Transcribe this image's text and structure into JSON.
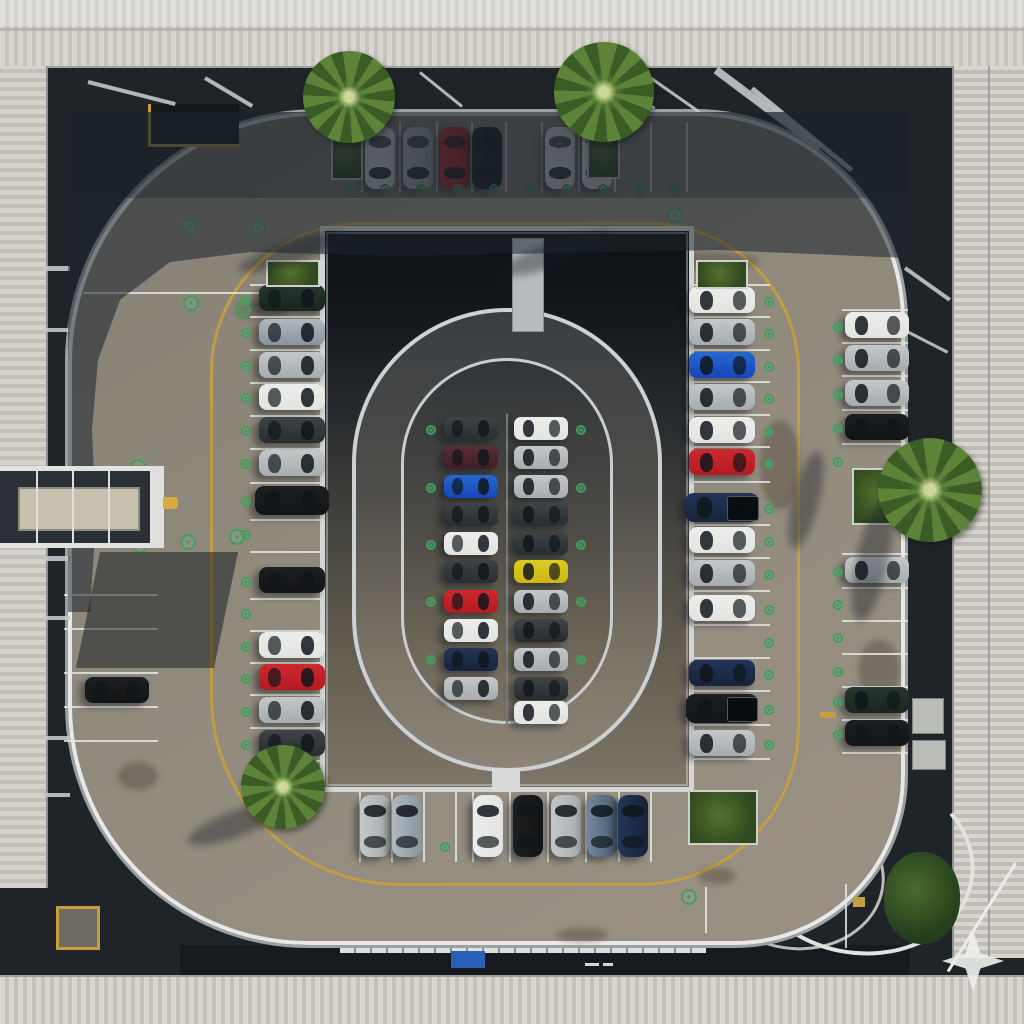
{
  "canvas": {
    "w": 1024,
    "h": 1024
  },
  "scene_palette": {
    "deck": "#8f897c",
    "gap": "#1f2428",
    "roof_light": "#d8d6cf",
    "roof_dark": "#c3c1ba",
    "curb_white": "#e8e9e6",
    "lane_yellow": "#c59e3d",
    "parking_line": "#e4e5e1",
    "ev_marker_green": "#3da05c",
    "shadow": "rgba(28,36,45,0.55)",
    "car_colors": {
      "white": "#e7e8e6",
      "silver": "#b4b8ba",
      "silverblue": "#99a5ad",
      "red": "#bf2127",
      "maroon": "#4a262b",
      "black": "#17191b",
      "darkgray": "#32373a",
      "darkgreen": "#1f2d26",
      "blue": "#1e55c4",
      "navy": "#1c2b48",
      "yellow": "#d4c019",
      "bluegray": "#5c7085"
    }
  },
  "car_groups": [
    {
      "name": "top-row",
      "o": "down",
      "cy": 158,
      "l": 62,
      "w": 30,
      "items": [
        {
          "p": 380,
          "c": "white"
        },
        {
          "p": 418,
          "c": "silver"
        },
        {
          "p": 455,
          "c": "red"
        },
        {
          "p": 487,
          "c": "black"
        },
        {
          "p": 560,
          "c": "white"
        },
        {
          "p": 597,
          "c": "white"
        }
      ]
    },
    {
      "name": "left-column",
      "o": "right",
      "cx": 292,
      "l": 66,
      "w": 26,
      "items": [
        {
          "p": 298,
          "c": "darkgreen"
        },
        {
          "p": 332,
          "c": "silverblue"
        },
        {
          "p": 365,
          "c": "silver"
        },
        {
          "p": 397,
          "c": "white"
        },
        {
          "p": 430,
          "c": "darkgray"
        },
        {
          "p": 463,
          "c": "silver"
        },
        {
          "p": 500,
          "c": "black",
          "l": 74,
          "w": 29
        },
        {
          "p": 580,
          "c": "black"
        },
        {
          "p": 645,
          "c": "white"
        },
        {
          "p": 677,
          "c": "red"
        },
        {
          "p": 710,
          "c": "silver"
        },
        {
          "p": 743,
          "c": "darkgray"
        }
      ]
    },
    {
      "name": "right-column",
      "o": "left",
      "cx": 722,
      "l": 66,
      "w": 26,
      "items": [
        {
          "p": 300,
          "c": "white"
        },
        {
          "p": 332,
          "c": "silver"
        },
        {
          "p": 365,
          "c": "blue"
        },
        {
          "p": 397,
          "c": "silver"
        },
        {
          "p": 430,
          "c": "white"
        },
        {
          "p": 462,
          "c": "red"
        },
        {
          "p": 507,
          "c": "navy",
          "l": 74,
          "w": 29,
          "truck": true
        },
        {
          "p": 540,
          "c": "white"
        },
        {
          "p": 573,
          "c": "silver"
        },
        {
          "p": 608,
          "c": "white"
        },
        {
          "p": 673,
          "c": "navy"
        },
        {
          "p": 708,
          "c": "black",
          "l": 72,
          "w": 29,
          "truck": true
        },
        {
          "p": 743,
          "c": "silver"
        }
      ]
    },
    {
      "name": "far-right-column",
      "o": "left",
      "cx": 877,
      "l": 64,
      "w": 26,
      "items": [
        {
          "p": 325,
          "c": "white"
        },
        {
          "p": 358,
          "c": "silver"
        },
        {
          "p": 393,
          "c": "silver"
        },
        {
          "p": 427,
          "c": "black"
        },
        {
          "p": 570,
          "c": "silver"
        },
        {
          "p": 700,
          "c": "darkgreen"
        },
        {
          "p": 733,
          "c": "black"
        }
      ]
    },
    {
      "name": "bottom-row",
      "o": "up",
      "cy": 826,
      "l": 62,
      "w": 30,
      "items": [
        {
          "p": 375,
          "c": "silver"
        },
        {
          "p": 407,
          "c": "silverblue"
        },
        {
          "p": 488,
          "c": "white"
        },
        {
          "p": 528,
          "c": "black"
        },
        {
          "p": 566,
          "c": "silver"
        },
        {
          "p": 602,
          "c": "bluegray"
        },
        {
          "p": 633,
          "c": "navy"
        }
      ]
    },
    {
      "name": "far-left",
      "o": "right",
      "cx": 117,
      "l": 64,
      "w": 26,
      "items": [
        {
          "p": 690,
          "c": "black"
        }
      ]
    },
    {
      "name": "center-left-column",
      "o": "right",
      "cx": 471,
      "l": 54,
      "w": 23,
      "items": [
        {
          "p": 428,
          "c": "darkgray"
        },
        {
          "p": 457,
          "c": "maroon"
        },
        {
          "p": 486,
          "c": "blue"
        },
        {
          "p": 514,
          "c": "darkgray"
        },
        {
          "p": 543,
          "c": "white"
        },
        {
          "p": 571,
          "c": "darkgray"
        },
        {
          "p": 601,
          "c": "red"
        },
        {
          "p": 630,
          "c": "white"
        },
        {
          "p": 659,
          "c": "navy"
        },
        {
          "p": 688,
          "c": "silver"
        }
      ]
    },
    {
      "name": "center-right-column",
      "o": "left",
      "cx": 541,
      "l": 54,
      "w": 23,
      "items": [
        {
          "p": 428,
          "c": "white"
        },
        {
          "p": 457,
          "c": "silver"
        },
        {
          "p": 486,
          "c": "silver"
        },
        {
          "p": 514,
          "c": "darkgray"
        },
        {
          "p": 543,
          "c": "darkgray"
        },
        {
          "p": 571,
          "c": "yellow"
        },
        {
          "p": 601,
          "c": "silver"
        },
        {
          "p": 630,
          "c": "darkgray"
        },
        {
          "p": 659,
          "c": "silver"
        },
        {
          "p": 688,
          "c": "darkgray"
        },
        {
          "p": 712,
          "c": "white"
        }
      ]
    }
  ],
  "line_groups": [
    {
      "dir": "v",
      "y1": 122,
      "y2": 192,
      "xs": [
        361,
        399,
        436,
        471,
        505,
        541,
        578,
        614,
        650,
        686
      ]
    },
    {
      "dir": "h",
      "x1": 250,
      "x2": 324,
      "ys": [
        284,
        316,
        349,
        382,
        415,
        448,
        482,
        519,
        551,
        598,
        630,
        662,
        694,
        727,
        760
      ]
    },
    {
      "dir": "h",
      "x1": 688,
      "x2": 770,
      "ys": [
        284,
        316,
        349,
        381,
        414,
        446,
        481,
        524,
        557,
        590,
        624,
        657,
        690,
        724,
        758
      ]
    },
    {
      "dir": "h",
      "x1": 842,
      "x2": 908,
      "ys": [
        309,
        342,
        375,
        409,
        443,
        553,
        587,
        620,
        653,
        686,
        719,
        752
      ]
    },
    {
      "dir": "v",
      "y1": 792,
      "y2": 862,
      "xs": [
        359,
        391,
        423,
        455,
        472,
        509,
        547,
        585,
        618,
        650
      ]
    },
    {
      "dir": "h",
      "x1": 436,
      "x2": 576,
      "ys": [
        414,
        443,
        471,
        500,
        528,
        557,
        586,
        614,
        643,
        671,
        700,
        726
      ]
    },
    {
      "dir": "h",
      "x1": 64,
      "x2": 158,
      "ys": [
        594,
        628,
        672,
        706,
        740
      ]
    },
    {
      "dir": "h",
      "x1": 84,
      "x2": 310,
      "ys": [
        292
      ]
    },
    {
      "dir": "v",
      "y1": 884,
      "y2": 948,
      "xs": [
        845
      ]
    },
    {
      "dir": "v",
      "y1": 887,
      "y2": 933,
      "xs": [
        705
      ]
    }
  ],
  "divider_lines": [
    {
      "x": 506,
      "y1": 414,
      "y2": 726
    }
  ],
  "markers": {
    "small": [
      [
        348,
        189
      ],
      [
        385,
        189
      ],
      [
        421,
        189
      ],
      [
        458,
        189
      ],
      [
        494,
        189
      ],
      [
        530,
        189
      ],
      [
        567,
        189
      ],
      [
        603,
        189
      ],
      [
        640,
        189
      ],
      [
        676,
        189
      ],
      [
        246,
        300
      ],
      [
        246,
        333
      ],
      [
        246,
        366
      ],
      [
        246,
        398
      ],
      [
        246,
        431
      ],
      [
        246,
        464
      ],
      [
        246,
        502
      ],
      [
        246,
        535
      ],
      [
        246,
        582
      ],
      [
        246,
        614
      ],
      [
        246,
        647
      ],
      [
        246,
        679
      ],
      [
        246,
        712
      ],
      [
        246,
        745
      ],
      [
        769,
        302
      ],
      [
        769,
        334
      ],
      [
        769,
        367
      ],
      [
        769,
        399
      ],
      [
        769,
        432
      ],
      [
        769,
        464
      ],
      [
        769,
        509
      ],
      [
        769,
        542
      ],
      [
        769,
        575
      ],
      [
        769,
        610
      ],
      [
        769,
        643
      ],
      [
        769,
        675
      ],
      [
        769,
        710
      ],
      [
        769,
        745
      ],
      [
        838,
        327
      ],
      [
        838,
        360
      ],
      [
        838,
        395
      ],
      [
        838,
        429
      ],
      [
        838,
        462
      ],
      [
        838,
        572
      ],
      [
        838,
        605
      ],
      [
        838,
        638
      ],
      [
        838,
        672
      ],
      [
        838,
        702
      ],
      [
        838,
        735
      ],
      [
        431,
        430
      ],
      [
        431,
        488
      ],
      [
        431,
        545
      ],
      [
        431,
        602
      ],
      [
        431,
        660
      ],
      [
        581,
        430
      ],
      [
        581,
        488
      ],
      [
        581,
        545
      ],
      [
        581,
        602
      ],
      [
        581,
        660
      ],
      [
        445,
        847
      ]
    ],
    "road": [
      [
        190,
        226
      ],
      [
        258,
        228
      ],
      [
        191,
        303
      ],
      [
        243,
        310
      ],
      [
        675,
        215
      ],
      [
        138,
        467
      ],
      [
        140,
        545
      ],
      [
        188,
        542
      ],
      [
        237,
        537
      ],
      [
        689,
        897
      ]
    ]
  },
  "palms": [
    {
      "x": 349,
      "y": 97,
      "r": 46
    },
    {
      "x": 604,
      "y": 92,
      "r": 50
    },
    {
      "x": 930,
      "y": 490,
      "r": 52
    },
    {
      "x": 283,
      "y": 787,
      "r": 42
    }
  ],
  "planters": [
    {
      "x": 331,
      "y": 128,
      "w": 32,
      "h": 52
    },
    {
      "x": 587,
      "y": 126,
      "w": 33,
      "h": 53
    },
    {
      "x": 852,
      "y": 468,
      "w": 60,
      "h": 57
    },
    {
      "x": 688,
      "y": 790,
      "w": 70,
      "h": 55
    },
    {
      "x": 266,
      "y": 260,
      "w": 54,
      "h": 27
    },
    {
      "x": 696,
      "y": 260,
      "w": 52,
      "h": 29
    },
    {
      "x": 254,
      "y": 766,
      "w": 64,
      "h": 36
    }
  ],
  "trees": [
    {
      "x": 922,
      "y": 898,
      "rx": 38,
      "ry": 46
    }
  ],
  "beams": [
    [
      88,
      82,
      175,
      104,
      4
    ],
    [
      205,
      78,
      252,
      106,
      4
    ],
    [
      420,
      72,
      462,
      106,
      3
    ],
    [
      598,
      74,
      655,
      108,
      3
    ],
    [
      716,
      70,
      820,
      148,
      8
    ],
    [
      752,
      88,
      852,
      170,
      5
    ],
    [
      640,
      70,
      700,
      112,
      3
    ],
    [
      44,
      268,
      70,
      268,
      5
    ],
    [
      44,
      330,
      70,
      330,
      4
    ],
    [
      44,
      558,
      70,
      558,
      5
    ],
    [
      44,
      618,
      70,
      618,
      4
    ],
    [
      44,
      738,
      70,
      738,
      4
    ],
    [
      44,
      795,
      70,
      795,
      4
    ],
    [
      905,
      268,
      950,
      300,
      4
    ],
    [
      905,
      330,
      948,
      352,
      3
    ],
    [
      336,
      254,
      408,
      298,
      3
    ],
    [
      680,
      254,
      608,
      298,
      3
    ],
    [
      330,
      250,
      688,
      250,
      3
    ],
    [
      334,
      272,
      684,
      272,
      2,
      0.4
    ],
    [
      338,
      284,
      680,
      284,
      2,
      0.3
    ]
  ],
  "palm_shadows": [
    [
      292,
      252,
      112,
      22,
      -18
    ],
    [
      556,
      254,
      122,
      24,
      -18
    ],
    [
      872,
      562,
      32,
      122,
      12
    ],
    [
      236,
      824,
      102,
      26,
      -20
    ],
    [
      806,
      500,
      26,
      100,
      14
    ]
  ],
  "smudges": [
    [
      300,
      700,
      60,
      26
    ],
    [
      235,
      300,
      54,
      20
    ],
    [
      640,
      252,
      120,
      18
    ],
    [
      858,
      640,
      42,
      60
    ],
    [
      118,
      762,
      40,
      28
    ],
    [
      698,
      868,
      38,
      16
    ],
    [
      556,
      928,
      52,
      14
    ],
    [
      420,
      250,
      84,
      16
    ],
    [
      500,
      340,
      90,
      20
    ],
    [
      760,
      420,
      40,
      90
    ]
  ],
  "extras": {
    "units": [
      [
        912,
        698,
        30,
        34
      ],
      [
        912,
        740,
        32,
        28
      ]
    ],
    "yellow_dashes": [
      [
        820,
        712,
        16,
        6
      ],
      [
        853,
        897,
        12,
        10
      ],
      [
        166,
        498,
        12,
        10
      ]
    ],
    "white_dashes": [
      [
        585,
        963,
        14,
        3
      ],
      [
        603,
        963,
        10,
        3
      ]
    ],
    "bridge_posts": [
      36,
      72,
      108
    ]
  }
}
